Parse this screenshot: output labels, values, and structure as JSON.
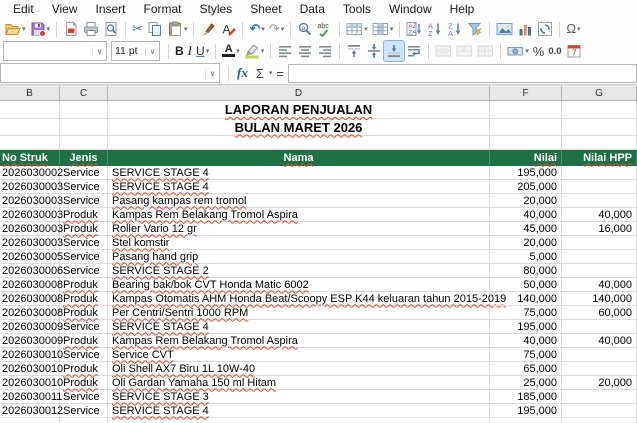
{
  "menu": {
    "items": [
      "Edit",
      "View",
      "Insert",
      "Format",
      "Styles",
      "Sheet",
      "Data",
      "Tools",
      "Window",
      "Help"
    ]
  },
  "toolbar": {
    "font_name": "",
    "font_size": "11 pt",
    "bold_label": "B",
    "italic_label": "I",
    "underline_label": "U",
    "font_color_label": "A",
    "percent_label": "%",
    "number_label": "0.0",
    "row1_icon_names": [
      "open-icon",
      "save-icon",
      "export-pdf-icon",
      "print-icon",
      "print-preview-icon",
      "cut-icon",
      "copy-icon",
      "paste-icon",
      "clone-formatting-icon",
      "clear-formatting-icon",
      "undo-icon",
      "redo-icon",
      "find-replace-icon",
      "spelling-icon",
      "rows-icon",
      "columns-icon",
      "sort-icon",
      "sort-ascending-icon",
      "sort-descending-icon",
      "autofilter-icon",
      "insert-image-icon",
      "insert-chart-icon",
      "pivot-table-icon",
      "special-character-icon"
    ],
    "row2_icon_names": [
      "font-name-combo",
      "font-size-combo",
      "bold-button",
      "italic-button",
      "underline-button",
      "font-color-icon",
      "highlight-color-icon",
      "align-left-icon",
      "align-center-icon",
      "align-right-icon",
      "align-top-icon",
      "center-vertically-icon",
      "align-bottom-icon",
      "wrap-text-icon",
      "merge-center-icon",
      "merge-cells-icon",
      "unmerge-cells-icon",
      "currency-icon",
      "percent-icon",
      "number-format-icon",
      "date-format-icon"
    ],
    "special_character_label": "Ω",
    "undo_glyph": "↶",
    "redo_glyph": "↷",
    "cut_glyph": "✂"
  },
  "formula_bar": {
    "name_box": "",
    "fx_label": "fx",
    "sum_label": "Σ",
    "equals_label": "=",
    "input": ""
  },
  "sheet": {
    "column_headers": [
      "B",
      "C",
      "D",
      "F",
      "G"
    ],
    "title_line1": "LAPORAN PENJUALAN",
    "title_line2": "BULAN MARET 2026",
    "colors": {
      "table_header_bg": "#1e7145",
      "table_header_text": "#ffffff",
      "gridline": "#dadada"
    },
    "table": {
      "headers": [
        "No Struk",
        "Jenis",
        "Nama",
        "Nilai",
        "Nilai HPP"
      ],
      "rows": [
        {
          "no_struk": "2026030002",
          "jenis": "Service",
          "nama": "SERVICE STAGE 4",
          "nilai": "195,000",
          "nilai_hpp": ""
        },
        {
          "no_struk": "2026030003",
          "jenis": "Service",
          "nama": "SERVICE STAGE 4",
          "nilai": "205,000",
          "nilai_hpp": ""
        },
        {
          "no_struk": "2026030003",
          "jenis": "Service",
          "nama": "Pasang kampas rem tromol",
          "nilai": "20,000",
          "nilai_hpp": ""
        },
        {
          "no_struk": "2026030003",
          "jenis": "Produk",
          "nama": "Kampas Rem Belakang Tromol Aspira",
          "nilai": "40,000",
          "nilai_hpp": "40,000"
        },
        {
          "no_struk": "2026030003",
          "jenis": "Produk",
          "nama": "Roller Vario 12 gr",
          "nilai": "45,000",
          "nilai_hpp": "16,000"
        },
        {
          "no_struk": "2026030003",
          "jenis": "Service",
          "nama": "Stel komstir",
          "nilai": "20,000",
          "nilai_hpp": ""
        },
        {
          "no_struk": "2026030005",
          "jenis": "Service",
          "nama": "Pasang hand grip",
          "nilai": "5,000",
          "nilai_hpp": ""
        },
        {
          "no_struk": "2026030006",
          "jenis": "Service",
          "nama": "SERVICE STAGE 2",
          "nilai": "80,000",
          "nilai_hpp": ""
        },
        {
          "no_struk": "2026030008",
          "jenis": "Produk",
          "nama": "Bearing bak/bok CVT Honda Matic 6002",
          "nilai": "50,000",
          "nilai_hpp": "40,000"
        },
        {
          "no_struk": "2026030008",
          "jenis": "Produk",
          "nama": "Kampas Otomatis AHM Honda Beat/Scoopy ESP K44 keluaran tahun 2015-2019",
          "nilai": "140,000",
          "nilai_hpp": "140,000"
        },
        {
          "no_struk": "2026030008",
          "jenis": "Produk",
          "nama": "Per Centri/Sentri 1000 RPM",
          "nilai": "75,000",
          "nilai_hpp": "60,000"
        },
        {
          "no_struk": "2026030009",
          "jenis": "Service",
          "nama": "SERVICE STAGE 4",
          "nilai": "195,000",
          "nilai_hpp": ""
        },
        {
          "no_struk": "2026030009",
          "jenis": "Produk",
          "nama": "Kampas Rem Belakang Tromol Aspira",
          "nilai": "40,000",
          "nilai_hpp": "40,000"
        },
        {
          "no_struk": "2026030010",
          "jenis": "Service",
          "nama": "Service CVT",
          "nilai": "75,000",
          "nilai_hpp": ""
        },
        {
          "no_struk": "2026030010",
          "jenis": "Produk",
          "nama": "Oli Shell AX7 Biru 1L 10W-40",
          "nilai": "65,000",
          "nilai_hpp": ""
        },
        {
          "no_struk": "2026030010",
          "jenis": "Produk",
          "nama": "Oli Gardan Yamaha 150 ml Hitam",
          "nilai": "25,000",
          "nilai_hpp": "20,000"
        },
        {
          "no_struk": "2026030011",
          "jenis": "Service",
          "nama": "SERVICE STAGE 3",
          "nilai": "185,000",
          "nilai_hpp": ""
        },
        {
          "no_struk": "2026030012",
          "jenis": "Service",
          "nama": "SERVICE STAGE 4",
          "nilai": "195,000",
          "nilai_hpp": ""
        }
      ]
    }
  }
}
